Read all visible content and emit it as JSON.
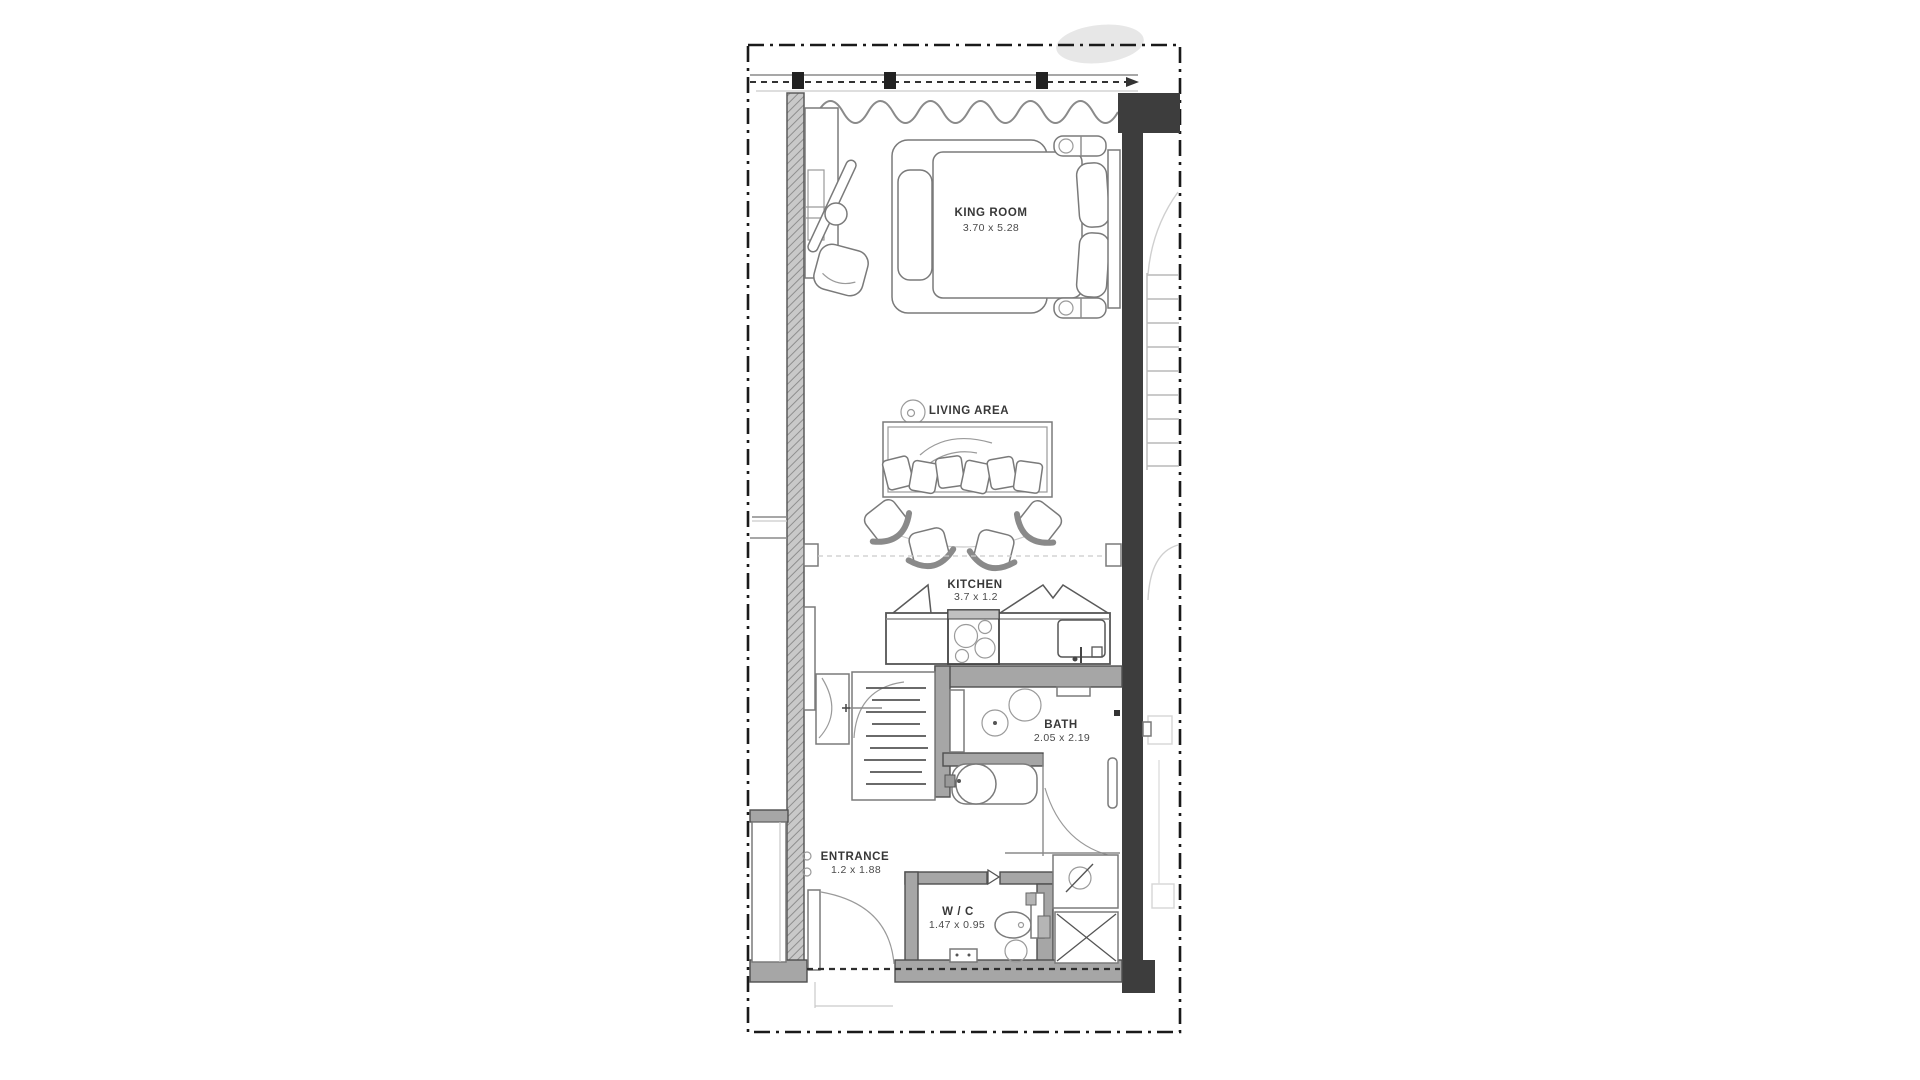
{
  "rooms": {
    "king": {
      "name": "KING ROOM",
      "dim": "3.70 x 5.28"
    },
    "living": {
      "name": "LIVING AREA"
    },
    "kitchen": {
      "name": "KITCHEN",
      "dim": "3.7 x 1.2"
    },
    "bath": {
      "name": "BATH",
      "dim": "2.05 x 2.19"
    },
    "entrance": {
      "name": "ENTRANCE",
      "dim": "1.2 x 1.88"
    },
    "wc": {
      "name": "W / C",
      "dim": "1.47 x 0.95"
    }
  },
  "colors": {
    "wall_dark": "#3d3d3d",
    "wall_gray": "#a6a6a6",
    "boundary": "#1a1a1a",
    "line": "#6e6e6e",
    "text": "#3b3b3b"
  }
}
